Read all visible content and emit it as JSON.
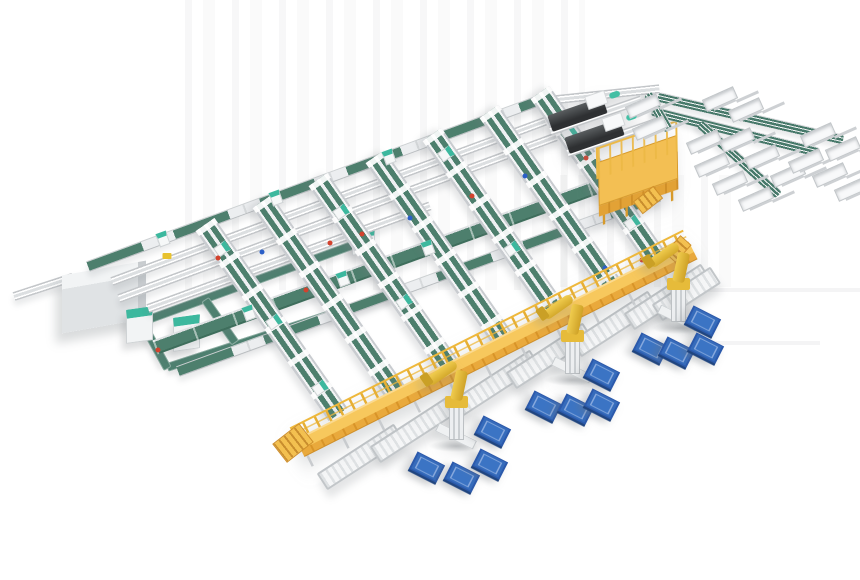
{
  "meta": {
    "canvas": {
      "w": 860,
      "h": 580
    }
  },
  "palette": {
    "background": "#ffffff",
    "conveyor_belt_green": "#4d7f6d",
    "conveyor_belt_green_deep": "#3e6e5c",
    "frame_light": "#f4f5f6",
    "frame_mid": "#d7dadc",
    "frame_dark": "#bfc3c6",
    "walkway_yellow": "#f7c85d",
    "walkway_side_orange": "#e9a93c",
    "railing_yellow": "#eeb83c",
    "robot_yellow": "#e6bb3a",
    "pallet_blue": "#3b74c4",
    "pallet_blue_dark": "#2b59ab",
    "machine_dark": "#3a3d3f",
    "teal_accent": "#43bfa4",
    "alarm_red": "#d2422e",
    "tag_blue": "#2b5fc7"
  },
  "artifacts": {
    "vertical_bands": [
      {
        "x": 185,
        "y": 0,
        "w": 400,
        "h": 290
      },
      {
        "x": 560,
        "y": 175,
        "w": 175,
        "h": 112
      }
    ],
    "horizontal_lines": [
      {
        "x": 688,
        "y": 288,
        "w": 172,
        "h": 4
      },
      {
        "x": 714,
        "y": 341,
        "w": 106,
        "h": 4
      }
    ]
  },
  "left_area": {
    "stub": {
      "x": 14,
      "y": 296,
      "angle": -18,
      "len": 62
    },
    "gray_box": {
      "x": 62,
      "y": 268,
      "w": 84,
      "h": 58
    },
    "cabinets": [
      {
        "x": 126,
        "y": 308,
        "w": 27,
        "h": 34
      },
      {
        "x": 173,
        "y": 316,
        "w": 27,
        "h": 34
      },
      {
        "x": 352,
        "y": 228,
        "w": 23,
        "h": 26
      }
    ],
    "loop_segments": [
      {
        "x": 143,
        "y": 321,
        "angle": -20,
        "len": 234
      },
      {
        "x": 363,
        "y": 241,
        "angle": 62,
        "len": 60
      },
      {
        "x": 167,
        "y": 367,
        "angle": -18,
        "len": 236
      },
      {
        "x": 142,
        "y": 322,
        "angle": 61,
        "len": 53
      },
      {
        "x": 205,
        "y": 299,
        "angle": 55,
        "len": 53
      }
    ]
  },
  "rows": [
    {
      "x": 88,
      "y": 266,
      "angle": -20.2,
      "len": 492,
      "style": "mixed"
    },
    {
      "x": 112,
      "y": 281,
      "angle": -20.3,
      "len": 462,
      "style": "rails"
    },
    {
      "x": 119,
      "y": 298,
      "angle": -20.3,
      "len": 466,
      "style": "rails"
    },
    {
      "x": 148,
      "y": 308,
      "angle": -20,
      "len": 300,
      "style": "rails"
    },
    {
      "x": 155,
      "y": 347,
      "angle": -20,
      "len": 535,
      "style": "green"
    },
    {
      "x": 178,
      "y": 371,
      "angle": -20,
      "len": 512,
      "style": "mixed"
    },
    {
      "x": 548,
      "y": 100,
      "angle": -6,
      "len": 112,
      "style": "rails"
    }
  ],
  "column_angle": 55,
  "columns": [
    {
      "x": 205,
      "y": 224,
      "len": 232
    },
    {
      "x": 262,
      "y": 201,
      "len": 232
    },
    {
      "x": 318,
      "y": 179,
      "len": 236
    },
    {
      "x": 375,
      "y": 156,
      "len": 230
    },
    {
      "x": 432,
      "y": 134,
      "len": 225
    },
    {
      "x": 489,
      "y": 111,
      "len": 219
    },
    {
      "x": 540,
      "y": 92,
      "len": 213
    }
  ],
  "carriers": [
    {
      "x": 222,
      "y": 249,
      "angle": 55
    },
    {
      "x": 274,
      "y": 322,
      "angle": 55
    },
    {
      "x": 320,
      "y": 388,
      "angle": 55
    },
    {
      "x": 341,
      "y": 212,
      "angle": 55
    },
    {
      "x": 404,
      "y": 302,
      "angle": 55
    },
    {
      "x": 446,
      "y": 154,
      "angle": 55
    },
    {
      "x": 512,
      "y": 249,
      "angle": 55
    },
    {
      "x": 569,
      "y": 133,
      "angle": 55
    },
    {
      "x": 632,
      "y": 223,
      "angle": 55
    },
    {
      "x": 163,
      "y": 239,
      "angle": -20
    },
    {
      "x": 276,
      "y": 198,
      "angle": -20
    },
    {
      "x": 389,
      "y": 157,
      "angle": -20
    },
    {
      "x": 249,
      "y": 313,
      "angle": -20
    },
    {
      "x": 343,
      "y": 279,
      "angle": -20
    },
    {
      "x": 428,
      "y": 248,
      "angle": -20
    }
  ],
  "dots": [
    {
      "x": 218,
      "y": 258,
      "c": "red"
    },
    {
      "x": 306,
      "y": 290,
      "c": "red"
    },
    {
      "x": 362,
      "y": 234,
      "c": "red"
    },
    {
      "x": 472,
      "y": 196,
      "c": "red"
    },
    {
      "x": 586,
      "y": 158,
      "c": "red"
    },
    {
      "x": 642,
      "y": 260,
      "c": "red"
    },
    {
      "x": 158,
      "y": 350,
      "c": "red"
    },
    {
      "x": 330,
      "y": 243,
      "c": "red"
    },
    {
      "x": 262,
      "y": 252,
      "c": "blue"
    },
    {
      "x": 410,
      "y": 218,
      "c": "blue"
    },
    {
      "x": 525,
      "y": 176,
      "c": "blue"
    },
    {
      "x": 605,
      "y": 268,
      "c": "blue"
    },
    {
      "x": 167,
      "y": 256,
      "c": "yellow"
    }
  ],
  "machine_angle": -19,
  "machines": [
    {
      "x": 546,
      "y": 112
    },
    {
      "x": 563,
      "y": 134
    }
  ],
  "platform": {
    "x": 598,
    "y": 162,
    "w": 84,
    "h": 52,
    "angle": -19,
    "stairs": {
      "x": 648,
      "y": 200,
      "angle": 52
    }
  },
  "sorter": {
    "runs": [
      {
        "x": 658,
        "y": 97,
        "angle": 13,
        "len": 190
      },
      {
        "x": 652,
        "y": 111,
        "angle": 14,
        "len": 172
      },
      {
        "x": 700,
        "y": 124,
        "angle": 42,
        "len": 106
      },
      {
        "x": 648,
        "y": 94,
        "angle": 60,
        "len": 42
      }
    ],
    "chute_angle": -24,
    "chutes": [
      {
        "x": 643,
        "y": 106
      },
      {
        "x": 650,
        "y": 128
      },
      {
        "x": 720,
        "y": 99
      },
      {
        "x": 746,
        "y": 110
      },
      {
        "x": 704,
        "y": 142
      },
      {
        "x": 712,
        "y": 165
      },
      {
        "x": 730,
        "y": 183
      },
      {
        "x": 756,
        "y": 199
      },
      {
        "x": 737,
        "y": 140
      },
      {
        "x": 762,
        "y": 157
      },
      {
        "x": 788,
        "y": 175
      },
      {
        "x": 806,
        "y": 161
      },
      {
        "x": 830,
        "y": 175
      },
      {
        "x": 852,
        "y": 189
      },
      {
        "x": 818,
        "y": 135
      },
      {
        "x": 843,
        "y": 149
      }
    ]
  },
  "spur_angle": -33,
  "spur_len": 92,
  "spurs": [
    {
      "x": 322,
      "y": 482
    },
    {
      "x": 375,
      "y": 455
    },
    {
      "x": 458,
      "y": 408
    },
    {
      "x": 511,
      "y": 381
    },
    {
      "x": 576,
      "y": 349
    },
    {
      "x": 629,
      "y": 322
    },
    {
      "x": 657,
      "y": 313,
      "len": 70
    }
  ],
  "walkway": {
    "x": 300,
    "y": 448,
    "angle": -26.7,
    "len": 440,
    "stairs": {
      "x": 293,
      "y": 443,
      "angle": 52
    },
    "ramp": {
      "x": 678,
      "y": 249,
      "angle": 42
    }
  },
  "robots": [
    {
      "x": 456,
      "y": 448
    },
    {
      "x": 572,
      "y": 382
    },
    {
      "x": 678,
      "y": 330
    }
  ],
  "pallets": [
    {
      "x": 493,
      "y": 431
    },
    {
      "x": 427,
      "y": 467
    },
    {
      "x": 462,
      "y": 477
    },
    {
      "x": 490,
      "y": 464
    },
    {
      "x": 602,
      "y": 374
    },
    {
      "x": 544,
      "y": 406
    },
    {
      "x": 576,
      "y": 409
    },
    {
      "x": 602,
      "y": 404
    },
    {
      "x": 703,
      "y": 321
    },
    {
      "x": 651,
      "y": 348
    },
    {
      "x": 677,
      "y": 352
    },
    {
      "x": 706,
      "y": 348
    }
  ]
}
